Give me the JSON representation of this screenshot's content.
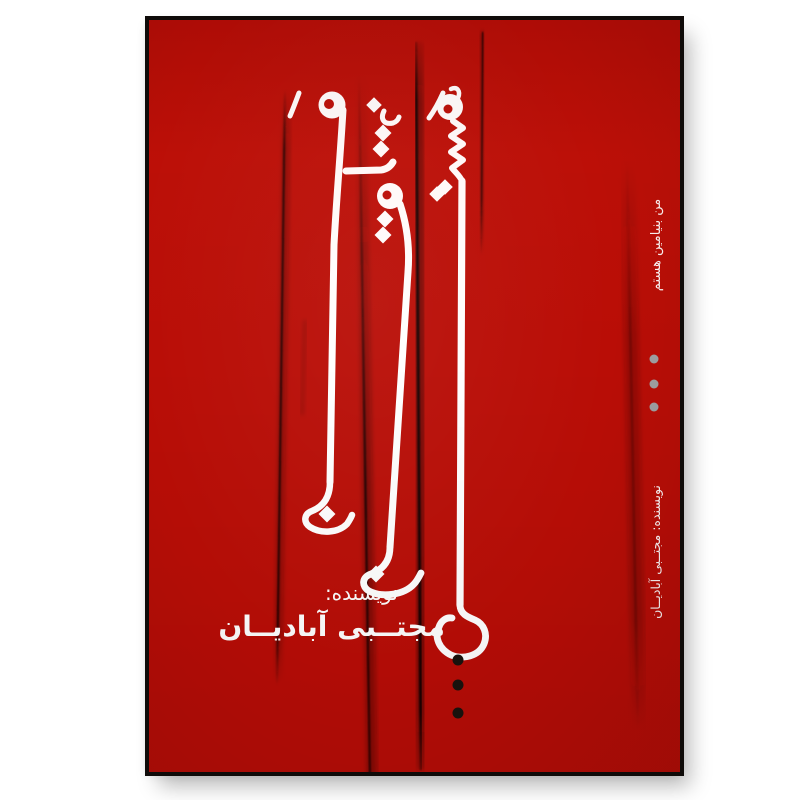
{
  "page": {
    "background_color": "#ffffff"
  },
  "poster": {
    "background_color": "#b90d06",
    "frame_color": "#0f0b09",
    "text_color": "#ffffff",
    "title_calligraphy": "بنیامین هستم",
    "spine_top_text": "من بنیامین هستم",
    "spine_bottom_text": "نویسنده: مجتــبی آبادیــان",
    "author_label": "نویسنده:",
    "author_name": "مجتــبی آبادیــان",
    "gray_dot_color": "#9fa0a2",
    "gray_dot_count": 3,
    "black_dot_color": "#19130e",
    "black_dot_count": 3
  }
}
